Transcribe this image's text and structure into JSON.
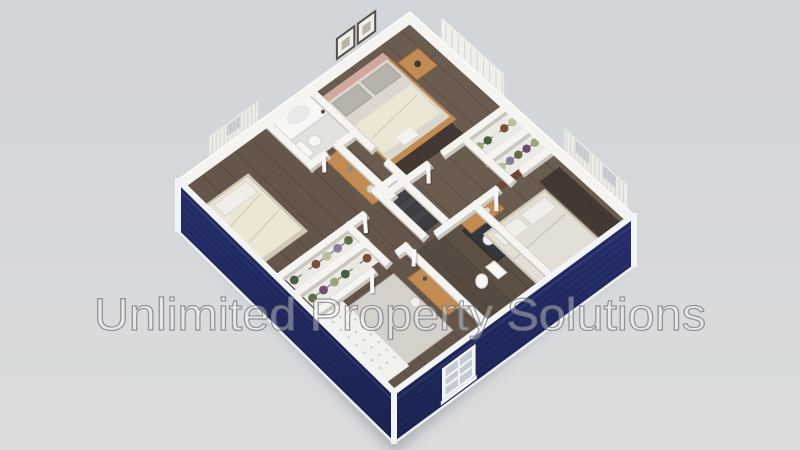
{
  "scene": {
    "type": "3d-isometric-floorplan-render",
    "watermark_text": "Unlimited Property Solutions"
  },
  "colors": {
    "background_top": "#d2d5d9",
    "background_bottom": "#dadcdd",
    "siding": "#28316f",
    "siding_dark": "#1c2453",
    "siding_line": "#141b40",
    "trim_white": "#f3f4f5",
    "wall_white": "#f5f4f1",
    "wall_edge": "#c9c6c0",
    "floor_wood": "#6b5c50",
    "plank_line": "#463b33",
    "tile_light": "#e2e1dd",
    "rug_light": "#d3d1ca",
    "runner_dark": "rgba(35,30,26,0.55)",
    "stair_dark": "#39383b",
    "stair_tread": "#4e4d52",
    "wood_furniture": "#c18b53",
    "wood_furniture_edge": "#9c6b3a",
    "linen_cream": "#ece6d4",
    "linen_base": "#cfc8b8",
    "duvet_gray": "#dbd7ce",
    "pillow_gray": "#b7b3ac",
    "pillow_white": "#f0eee8",
    "headboard_pink": "#d2a79e",
    "fixture_white": "#f7f7f5",
    "fixture_edge": "#d5d4d0",
    "vanity_dark": "#33373a",
    "door_brown": "#6b4730",
    "glass_blue": "#c3cad3",
    "curtain_light": "#edece8",
    "curtain_fold": "#d5d3cf",
    "frame_dark": "#55524e",
    "lace_dot": "#cfcabe",
    "shadow": "rgba(80,86,96,0.32)",
    "watermark_fill": "rgba(255,255,255,0.36)",
    "watermark_stroke": "rgba(108,112,118,0.68)",
    "clothes_palette": [
      "#5f7048",
      "#8a7d99",
      "#b9c0a0",
      "#7c4f38",
      "#e8e6df",
      "#46603f",
      "#9aa57e",
      "#6b4f6e"
    ]
  },
  "rooms": [
    {
      "name": "bedroom-top",
      "furniture": [
        "double-bed",
        "nightstand",
        "table-lamp",
        "wall-art-frames",
        "wardrobe"
      ]
    },
    {
      "name": "bathroom-top-left",
      "furniture": [
        "bathtub",
        "toilet",
        "shower-fixture"
      ]
    },
    {
      "name": "bedroom-left",
      "furniture": [
        "double-bed",
        "dresser",
        "decor-vase",
        "window-curtains"
      ]
    },
    {
      "name": "walk-in-closet-left",
      "furniture": [
        "clothes-racks"
      ]
    },
    {
      "name": "bedroom-bottom",
      "furniture": [
        "bed-lace-throw",
        "desk",
        "stool",
        "area-rug",
        "door-open"
      ]
    },
    {
      "name": "bathroom-right",
      "furniture": [
        "vanity-sink",
        "mirror",
        "toilet"
      ]
    },
    {
      "name": "bedroom-right",
      "furniture": [
        "double-bed",
        "desk",
        "door-open",
        "window-curtains"
      ]
    },
    {
      "name": "closet-right",
      "furniture": [
        "clothes-racks"
      ]
    },
    {
      "name": "hallway",
      "furniture": [
        "staircase"
      ]
    }
  ]
}
